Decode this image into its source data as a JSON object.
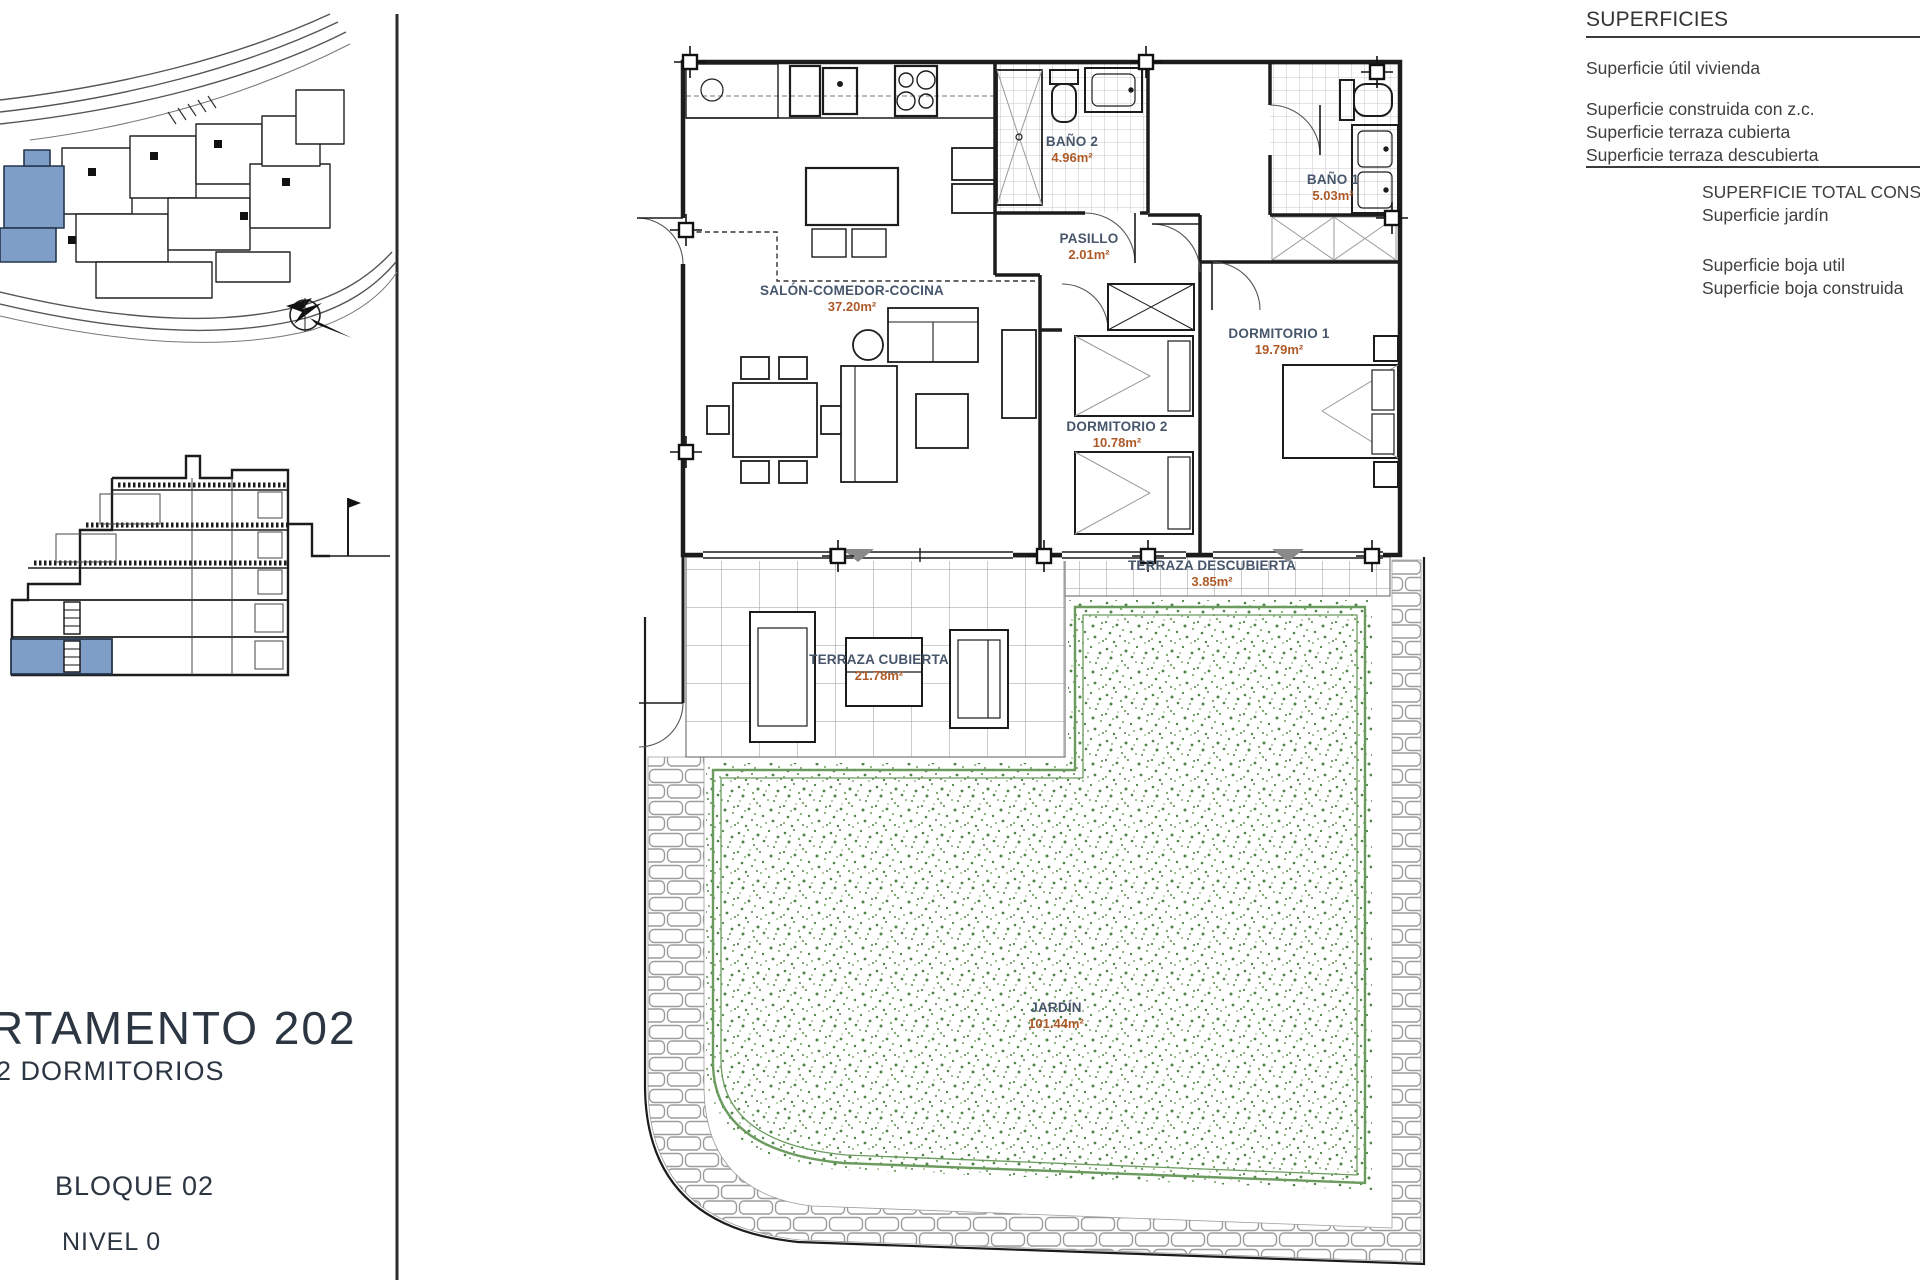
{
  "superficies": {
    "title": "SUPERFICIES",
    "row_util": "Superficie útil vivienda",
    "row_construida": "Superficie construida con z.c.",
    "row_terraza_cubierta": "Superficie terraza cubierta",
    "row_terraza_descubierta": "Superficie terraza descubierta",
    "row_total": "SUPERFICIE TOTAL CONSTR",
    "row_jardin": "Superficie jardín",
    "row_boja_util": "Superficie boja util",
    "row_boja_construida": "Superficie boja construida"
  },
  "title_block": {
    "apartment": "RTAMENTO 202",
    "type": "2 DORMITORIOS",
    "block": "BLOQUE 02",
    "level": "NIVEL 0"
  },
  "rooms": {
    "salon": {
      "name": "SALÓN-COMEDOR-COCINA",
      "area": "37.20m²"
    },
    "bano2": {
      "name": "BAÑO 2",
      "area": "4.96m²"
    },
    "pasillo": {
      "name": "PASILLO",
      "area": "2.01m²"
    },
    "bano1": {
      "name": "BAÑO 1",
      "area": "5.03m²"
    },
    "dorm1": {
      "name": "DORMITORIO 1",
      "area": "19.79m²"
    },
    "dorm2": {
      "name": "DORMITORIO 2",
      "area": "10.78m²"
    },
    "terraza_desc": {
      "name": "TERRAZA DESCUBIERTA",
      "area": "3.85m²"
    },
    "terraza_cub": {
      "name": "TERRAZA CUBIERTA",
      "area": "21.78m²"
    },
    "jardin": {
      "name": "JARDÍN",
      "area": "101.44m²"
    }
  },
  "colors": {
    "highlight_blue": "#7f9ec7",
    "room_name": "#47566b",
    "room_area": "#ad5a28",
    "garden_green": "#5d8f53",
    "line_dark": "#1c1c1c"
  }
}
